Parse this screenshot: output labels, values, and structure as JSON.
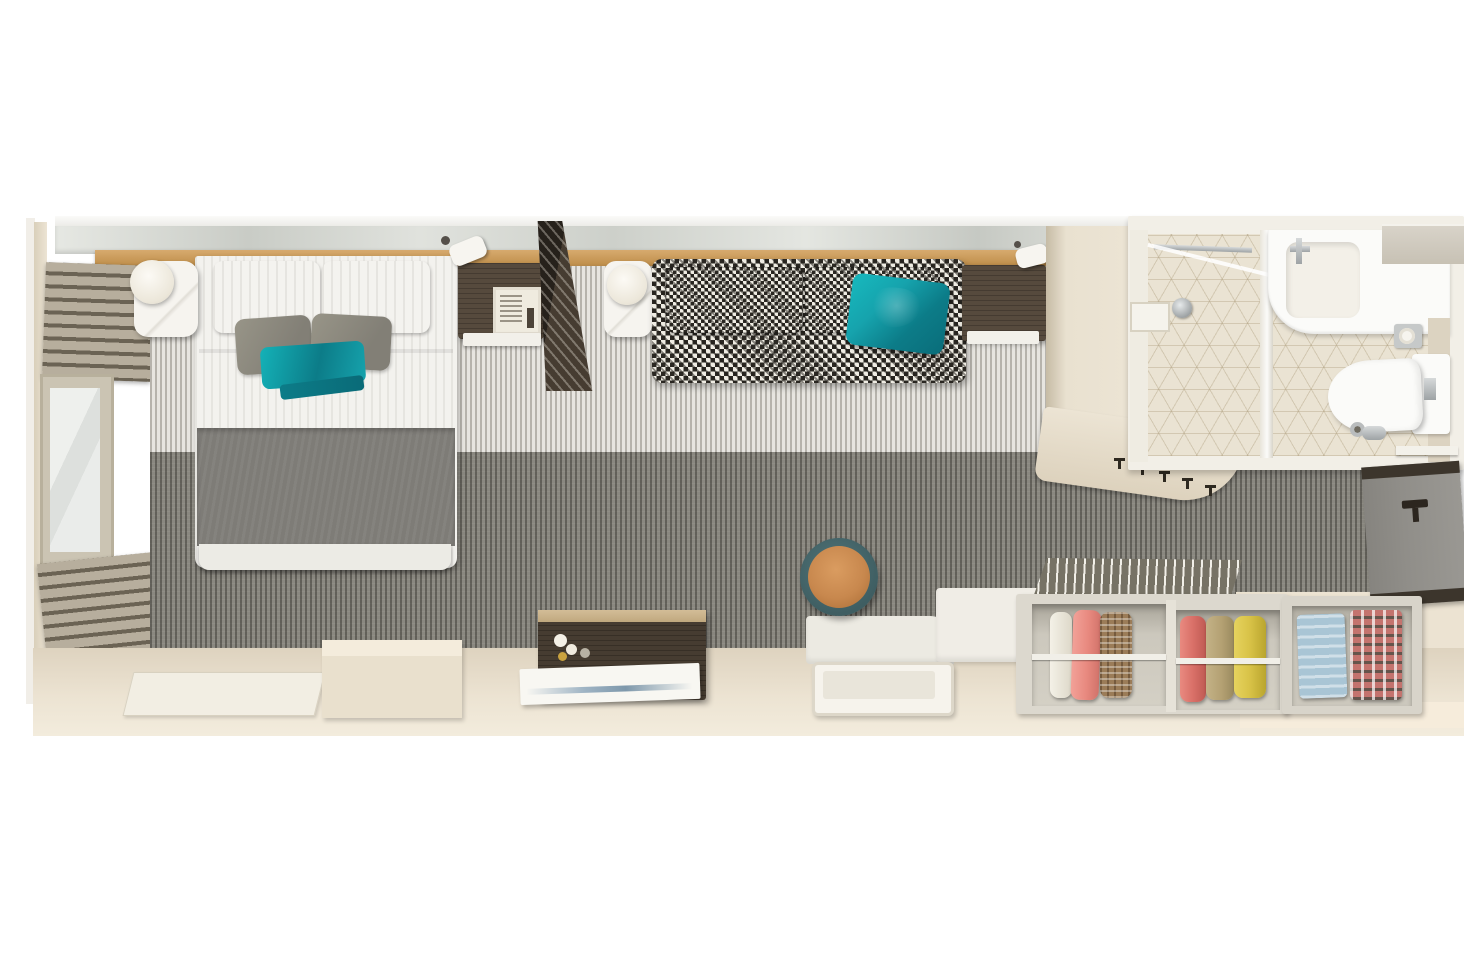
{
  "canvas": {
    "width": 1464,
    "height": 976
  },
  "scene": {
    "description": "Top-down 3D cutaway rendering of a narrow cruise-ship stateroom floor plan, no visible text",
    "rooms": [
      {
        "id": "sleeping-area",
        "contents": [
          "double-bed",
          "nightstand-left",
          "nightstand-right",
          "window-with-blinds"
        ]
      },
      {
        "id": "lounge-area",
        "contents": [
          "houndstooth-sofa",
          "side-table",
          "tv-divider-panel",
          "wall-desk",
          "stool",
          "dresser",
          "vanity"
        ]
      },
      {
        "id": "bathroom",
        "contents": [
          "shower",
          "sink-counter",
          "toilet",
          "towel-bar"
        ]
      },
      {
        "id": "entry",
        "contents": [
          "minibar-cabinet",
          "coat-hooks",
          "wardrobe-closet",
          "shelf-unit"
        ]
      }
    ],
    "furniture": [
      {
        "id": "double-bed",
        "label": "double bed with white duvet, gray blanket, gray and teal pillows"
      },
      {
        "id": "houndstooth-sofa",
        "label": "black-and-white houndstooth sofa with teal throw"
      },
      {
        "id": "wardrobe-closet",
        "label": "open-top wardrobe with hanging clothes (white, pink, brown, red, tan, yellow)"
      },
      {
        "id": "shelf-unit",
        "label": "shelf with folded blue and plaid clothing"
      },
      {
        "id": "stool",
        "label": "round stool, tan leather top with dark teal rim"
      },
      {
        "id": "bathroom-suite",
        "label": "shower, white sink counter, toilet on beige cube-pattern tile"
      }
    ]
  },
  "palette": {
    "wallCut": "#ece4d4",
    "wallCutShade": "#d9cfba",
    "blindSlat": "#b7ae9d",
    "blindGap": "#6b6354",
    "carpetLightA": "#e7e5e0",
    "carpetDarkA": "#8a8880",
    "bedWhite": "#f3f2ee",
    "blanketGray": "#7e7c77",
    "teal": "#16a3ad",
    "tealDark": "#0c7c88",
    "darkWood": "#564a3d",
    "darkWood2": "#463c31",
    "marbleWhite": "#f6f4ef",
    "houndA": "#2a2722",
    "houndB": "#efece3",
    "stoolRing": "#3f5e62",
    "stoolTop": "#c8884e",
    "bathFloor": "#eae3d3",
    "fixtureWhite": "#fbfbf9",
    "minibarFace": "#908e89",
    "minibarTrim": "#3c352c",
    "clothesPink": "#e8897f",
    "clothesBrown": "#9b7c58",
    "clothesRed": "#d97068",
    "clothesTan": "#b4a173",
    "clothesYellow": "#d8c247",
    "clothesBlue": "#a9c5d5",
    "clothesPlaidA": "#c4736e",
    "floorBeige": "#ded3bf",
    "floorBeigeLight": "#ece3d2"
  }
}
